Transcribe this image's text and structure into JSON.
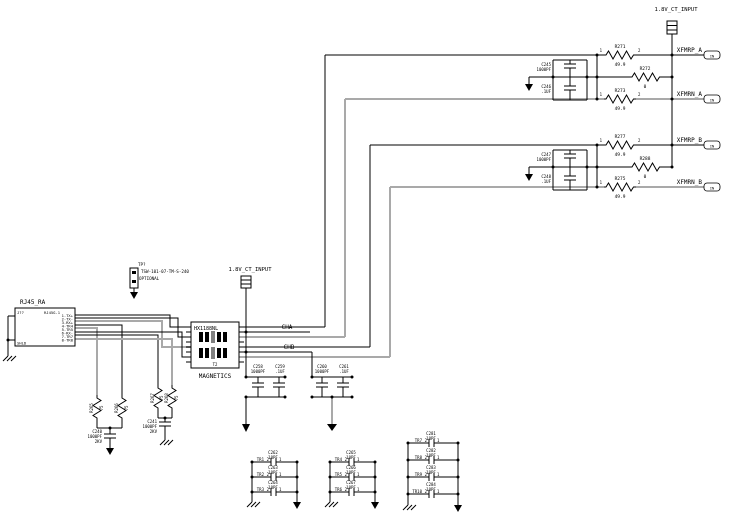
{
  "power_net": "1.8V_CT_INPUT",
  "offpage_tag": "IN",
  "nets": {
    "cha": "CHA",
    "chb": "CHB"
  },
  "pin1": "1",
  "pin2": "2",
  "groups": [
    {
      "net_p": "XFMRP_A",
      "net_n": "XFMRN_A",
      "r_top_ref": "R271",
      "r_top_val": "49.9",
      "r_mid_ref": "R272",
      "r_mid_val": "0",
      "r_bot_ref": "R273",
      "r_bot_val": "49.9",
      "c1_ref": "C245",
      "c1_val": "1000PF",
      "c2_ref": "C246",
      "c2_val": ".1UF"
    },
    {
      "net_p": "XFMRP_B",
      "net_n": "XFMRN_B",
      "r_top_ref": "R277",
      "r_top_val": "49.9",
      "r_mid_ref": "R288",
      "r_mid_val": "0",
      "r_bot_ref": "R275",
      "r_bot_val": "49.9",
      "c1_ref": "C247",
      "c1_val": "1000PF",
      "c2_ref": "C248",
      "c2_val": ".1UF"
    }
  ],
  "bypass": [
    {
      "c1_ref": "C258",
      "c1_val": "1000PF",
      "c2_ref": "C259",
      "c2_val": ".1UF"
    },
    {
      "c1_ref": "C260",
      "c1_val": "1000PF",
      "c2_ref": "C261",
      "c2_val": ".1UF"
    }
  ],
  "magnetics": {
    "part": "HX1188NL",
    "ref": "T2",
    "label": "MAGNETICS"
  },
  "rj45": {
    "title": "RJ45_RA",
    "ref": "J??",
    "part": "RJ45G-1",
    "shield": "SHLD",
    "pins": [
      "1-TX+",
      "2-TX-",
      "3-RX+",
      "4-TR4",
      "5-TR5",
      "6-RX-",
      "7-TR7",
      "8-TR8"
    ]
  },
  "tp": {
    "ref": "TP?",
    "part": "TSW-101-07-TM-S-240",
    "note": "OPTIONAL"
  },
  "bob": [
    {
      "r1_ref": "R265",
      "r1_val": "75",
      "r2_ref": "R266",
      "r2_val": "75",
      "c_ref": "C240",
      "c_val": "1000PF",
      "c_rating": "2KV"
    },
    {
      "r1_ref": "R267",
      "r1_val": "75",
      "r2_ref": "R268",
      "r2_val": "75",
      "c_ref": "C241",
      "c_val": "1000PF",
      "c_rating": "2KV"
    }
  ],
  "banks": [
    {
      "rows": [
        {
          "net": "TR1",
          "ref": "C262",
          "val": "10PF"
        },
        {
          "net": "TR2",
          "ref": "C263",
          "val": "10PF"
        },
        {
          "net": "TR3",
          "ref": "C264",
          "val": "10PF"
        }
      ]
    },
    {
      "rows": [
        {
          "net": "TR4",
          "ref": "C265",
          "val": "10PF"
        },
        {
          "net": "TR5",
          "ref": "C266",
          "val": "10PF"
        },
        {
          "net": "TR6",
          "ref": "C267",
          "val": "10PF"
        }
      ]
    },
    {
      "rows": [
        {
          "net": "TR7",
          "ref": "C281",
          "val": "10PF"
        },
        {
          "net": "TR8",
          "ref": "C282",
          "val": "10PF"
        },
        {
          "net": "TR9",
          "ref": "C283",
          "val": "10PF"
        },
        {
          "net": "TR10",
          "ref": "C284",
          "val": "10PF"
        }
      ]
    }
  ]
}
